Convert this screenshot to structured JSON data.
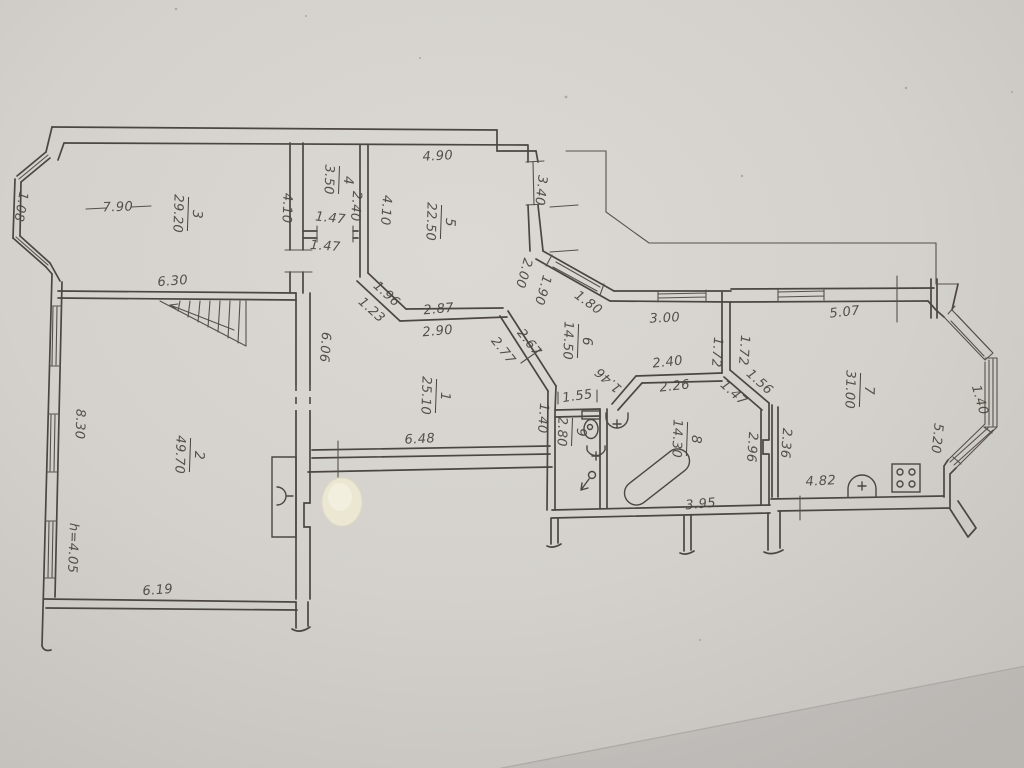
{
  "document_type": "hand-drawn apartment floor plan (photographed paper)",
  "palette": {
    "paper": "#d6d3ce",
    "ink": "#4b4641",
    "pencil_text": "#49443e",
    "whiteout": "#efebd9"
  },
  "rooms": [
    {
      "number": "1",
      "area": "25.10"
    },
    {
      "number": "2",
      "area": "49.70"
    },
    {
      "number": "3",
      "area": "29.20"
    },
    {
      "number": "4",
      "area": "3.50"
    },
    {
      "number": "5",
      "area": "22.50"
    },
    {
      "number": "6",
      "area": "14.50"
    },
    {
      "number": "7",
      "area": "31.00"
    },
    {
      "number": "8",
      "area": "14.30"
    },
    {
      "number": "9",
      "area": "2.80"
    }
  ],
  "dims": {
    "w7_90": "7.90",
    "w6_30": "6.30",
    "w1_08": "1.08",
    "w4_10a": "4.10",
    "w1_47a": "1.47",
    "w1_47b": "1.47",
    "w2_40a": "2.40",
    "w4_10b": "4.10",
    "w4_90": "4.90",
    "w3_40": "3.40",
    "w2_00": "2.00",
    "w1_90": "1.90",
    "w1_80": "1.80",
    "w3_00": "3.00",
    "w1_96": "1.96",
    "w1_23": "1.23",
    "w2_87": "2.87",
    "w2_90": "2.90",
    "w2_67": "2.67",
    "w2_77": "2.77",
    "w6_06": "6.06",
    "w8_30": "8.30",
    "wh4_05": "h=4.05",
    "w6_19": "6.19",
    "w6_48": "6.48",
    "w1_40a": "1.40",
    "w1_55": "1.55",
    "w2_40b": "2.40",
    "w2_26": "2.26",
    "w1_46": "1.46",
    "w1_72a": "1.72",
    "w1_72b": "1.72",
    "w1_56": "1.56",
    "w1_47c": "1.47",
    "w2_96": "2.96",
    "w2_36": "2.36",
    "w3_95": "3.95",
    "w5_07": "5.07",
    "w4_82": "4.82",
    "w5_20": "5.20",
    "w1_40b": "1.40"
  }
}
